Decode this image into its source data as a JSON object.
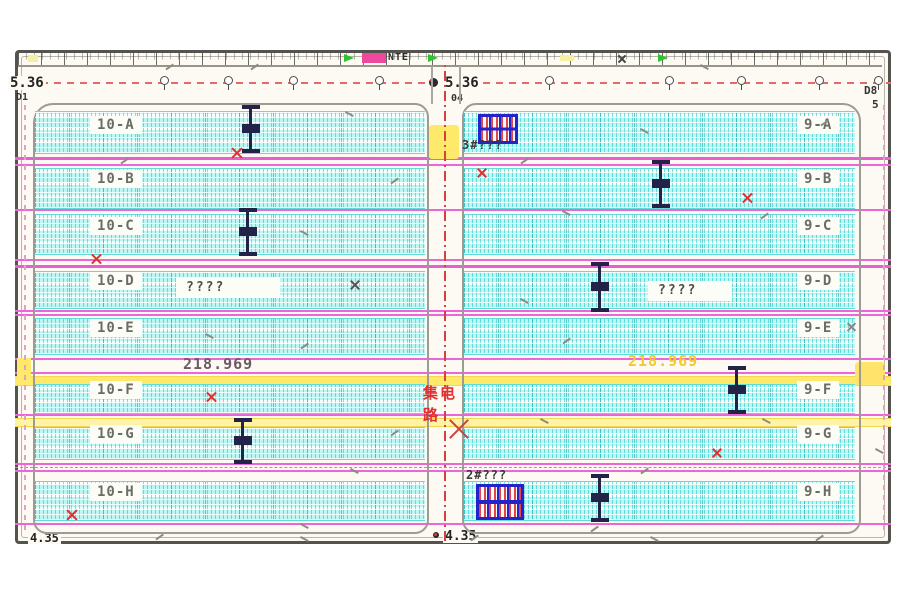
{
  "annotations": {
    "top_left_elevation": "5.36",
    "top_left_code": "D1",
    "top_center_elevation": "5.36",
    "top_center_code": "04",
    "top_right_code": "D8",
    "top_right_code2": "5",
    "bottom_left_elevation": "4.35",
    "bottom_center_elevation": "4.35",
    "ruler_tag": "NTE",
    "chainage_left": "218.969",
    "chainage_right": "218.969"
  },
  "road": {
    "label_line1": "集电",
    "label_line2": "路"
  },
  "stations": {
    "top_label": "3#???",
    "bottom_label": "2#???"
  },
  "blocks": {
    "left": {
      "rows": [
        {
          "label": "10-A"
        },
        {
          "label": "10-B"
        },
        {
          "label": "10-C"
        },
        {
          "label": "10-D"
        },
        {
          "label": "10-E"
        },
        {
          "label": "10-F"
        },
        {
          "label": "10-G"
        },
        {
          "label": "10-H"
        }
      ],
      "row_d_note": "????"
    },
    "right": {
      "rows": [
        {
          "label": "9-A"
        },
        {
          "label": "9-B"
        },
        {
          "label": "9-C"
        },
        {
          "label": "9-D"
        },
        {
          "label": "9-E"
        },
        {
          "label": "9-F"
        },
        {
          "label": "9-G"
        },
        {
          "label": "9-H"
        }
      ],
      "row_d_note": "????"
    }
  },
  "colors": {
    "panel_cyan": "#bdf6f3",
    "magenta": "#ec66d8",
    "yellow": "#ffe96a",
    "red": "#e03030",
    "blue": "#2323cc",
    "navy": "#23234a"
  }
}
